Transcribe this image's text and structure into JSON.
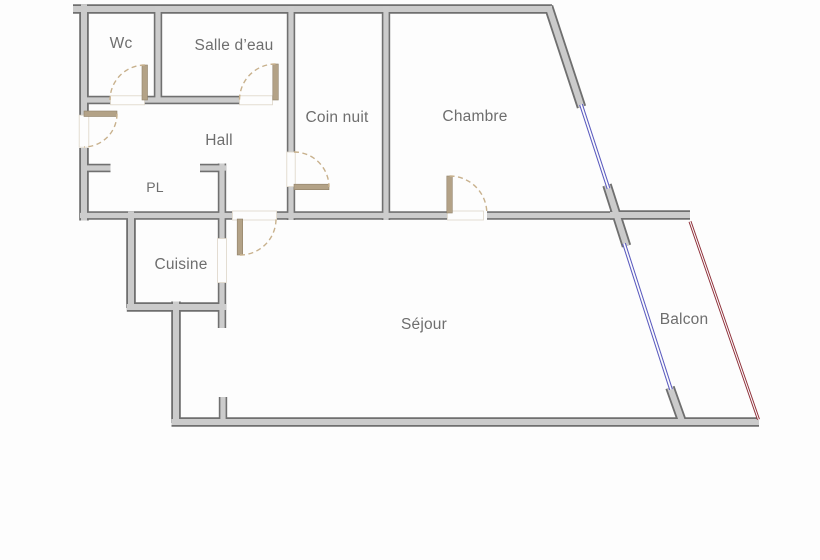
{
  "plan": {
    "type": "apartment-floor-plan",
    "rooms": [
      {
        "id": "wc",
        "label": "Wc"
      },
      {
        "id": "salle_deau",
        "label": "Salle d’eau"
      },
      {
        "id": "coin_nuit",
        "label": "Coin nuit"
      },
      {
        "id": "chambre",
        "label": "Chambre"
      },
      {
        "id": "hall",
        "label": "Hall"
      },
      {
        "id": "pl",
        "label": "PL"
      },
      {
        "id": "cuisine",
        "label": "Cuisine"
      },
      {
        "id": "sejour",
        "label": "Séjour"
      },
      {
        "id": "balcon",
        "label": "Balcon"
      }
    ],
    "features": {
      "doors": [
        "entrance-door",
        "wc-door",
        "salle-deau-door",
        "coin-nuit-door",
        "chambre-door",
        "sejour-door"
      ],
      "windows": [
        "chambre-window",
        "sejour-window"
      ],
      "railing": [
        "balcon-railing"
      ]
    }
  },
  "colors": {
    "background": "#fdfdfd",
    "wall_fill": "#cbcbcb",
    "wall_outline": "#6f6f6f",
    "door_leaf": "#b3a287",
    "door_arc": "#c8b18d",
    "window_blue": "#5b5bbf",
    "railing_red": "#8e2e38",
    "label_text": "#6e6e6e"
  }
}
